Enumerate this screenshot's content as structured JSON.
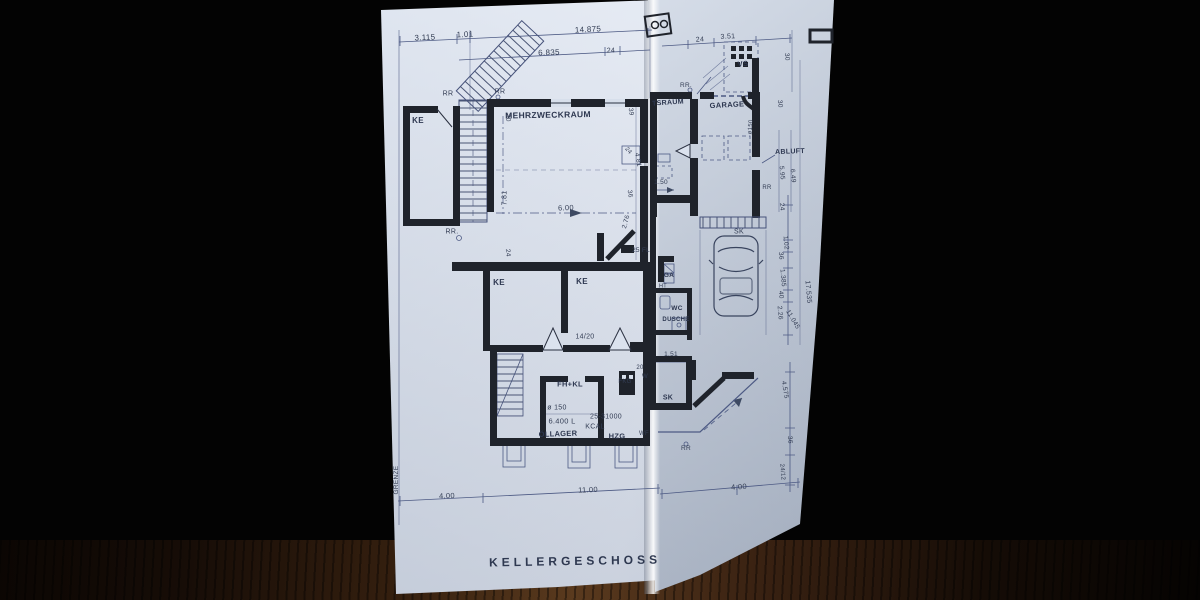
{
  "title": {
    "text": "KELLERGESCHOSS"
  },
  "colors": {
    "paper": "#d3dbe8",
    "ink": "#3e4a63",
    "wall": "#1f232b",
    "wood": "#3a2315"
  },
  "annotations": [
    {
      "kind": "dim",
      "text": "3.115",
      "x": 425,
      "y": 38,
      "rot": -3,
      "fs": 8
    },
    {
      "kind": "dim",
      "text": "1.01",
      "x": 465,
      "y": 35,
      "rot": -3,
      "fs": 8
    },
    {
      "kind": "dim",
      "text": "14.875",
      "x": 588,
      "y": 30,
      "rot": -3,
      "fs": 8
    },
    {
      "kind": "dim",
      "text": "6.835",
      "x": 549,
      "y": 53,
      "rot": -2,
      "fs": 8
    },
    {
      "kind": "dim",
      "text": "24",
      "x": 611,
      "y": 51,
      "rot": -2,
      "fs": 7
    },
    {
      "kind": "marker",
      "text": "RR",
      "x": 448,
      "y": 94,
      "rot": 0,
      "fs": 7
    },
    {
      "kind": "marker",
      "text": "RR",
      "x": 500,
      "y": 92,
      "rot": 0,
      "fs": 7
    },
    {
      "kind": "room",
      "text": "KE",
      "x": 418,
      "y": 121,
      "rot": 0,
      "fs": 8
    },
    {
      "kind": "room",
      "text": "MEHRZWECKRAUM",
      "x": 548,
      "y": 115,
      "rot": -1,
      "fs": 8.5
    },
    {
      "kind": "dim",
      "text": "30",
      "x": 507,
      "y": 118,
      "rot": 85,
      "fs": 6.5
    },
    {
      "kind": "dim",
      "text": "7.81",
      "x": 505,
      "y": 198,
      "rot": -90,
      "fs": 7
    },
    {
      "kind": "dim",
      "text": "6.00",
      "x": 566,
      "y": 208,
      "rot": -2,
      "fs": 7.5
    },
    {
      "kind": "dim",
      "text": "2.76",
      "x": 627,
      "y": 222,
      "rot": -75,
      "fs": 6.5
    },
    {
      "kind": "dim",
      "text": "39",
      "x": 630,
      "y": 112,
      "rot": 80,
      "fs": 6.5
    },
    {
      "kind": "dim",
      "text": "24",
      "x": 628,
      "y": 151,
      "rot": 50,
      "fs": 6
    },
    {
      "kind": "dim",
      "text": "4.81",
      "x": 637,
      "y": 160,
      "rot": 80,
      "fs": 6.5
    },
    {
      "kind": "dim",
      "text": "36",
      "x": 629,
      "y": 194,
      "rot": 80,
      "fs": 6.5
    },
    {
      "kind": "marker",
      "text": "RR.",
      "x": 452,
      "y": 232,
      "rot": 0,
      "fs": 7
    },
    {
      "kind": "dim",
      "text": "24",
      "x": 507,
      "y": 253,
      "rot": 85,
      "fs": 6.5
    },
    {
      "kind": "marker",
      "text": "25 FL",
      "x": 641,
      "y": 251,
      "rot": 0,
      "fs": 6.5
    },
    {
      "kind": "room",
      "text": "KE",
      "x": 499,
      "y": 283,
      "rot": 0,
      "fs": 8
    },
    {
      "kind": "room",
      "text": "KE",
      "x": 582,
      "y": 282,
      "rot": 0,
      "fs": 8
    },
    {
      "kind": "dim",
      "text": "14/20",
      "x": 585,
      "y": 337,
      "rot": 0,
      "fs": 7
    },
    {
      "kind": "room",
      "text": "FH+KL",
      "x": 570,
      "y": 384,
      "rot": 0,
      "fs": 7.5
    },
    {
      "kind": "marker",
      "text": "FKG",
      "x": 625,
      "y": 382,
      "rot": 0,
      "fs": 6
    },
    {
      "kind": "dim",
      "text": "20",
      "x": 640,
      "y": 368,
      "rot": 0,
      "fs": 6
    },
    {
      "kind": "marker",
      "text": "W",
      "x": 645,
      "y": 377,
      "rot": 0,
      "fs": 6
    },
    {
      "kind": "dim",
      "text": "ø 150",
      "x": 557,
      "y": 408,
      "rot": 0,
      "fs": 7
    },
    {
      "kind": "dim",
      "text": "6.400 L",
      "x": 562,
      "y": 421,
      "rot": 0,
      "fs": 7.5
    },
    {
      "kind": "room",
      "text": "ÖLLAGER",
      "x": 558,
      "y": 434,
      "rot": -2,
      "fs": 7.5
    },
    {
      "kind": "dim",
      "text": "25-31000",
      "x": 606,
      "y": 417,
      "rot": 0,
      "fs": 7
    },
    {
      "kind": "dim",
      "text": "KCAL",
      "x": 595,
      "y": 427,
      "rot": 0,
      "fs": 7
    },
    {
      "kind": "room",
      "text": "HZG",
      "x": 617,
      "y": 436,
      "rot": 0,
      "fs": 7.5
    },
    {
      "kind": "marker",
      "text": "WF",
      "x": 644,
      "y": 434,
      "rot": 0,
      "fs": 6
    },
    {
      "kind": "marker",
      "text": "GRENZE",
      "x": 397,
      "y": 480,
      "rot": -90,
      "fs": 6.5
    },
    {
      "kind": "dim",
      "text": "4.00",
      "x": 447,
      "y": 496,
      "rot": -2,
      "fs": 7.5
    },
    {
      "kind": "dim",
      "text": "11.00",
      "x": 588,
      "y": 490,
      "rot": -2,
      "fs": 7.5
    },
    {
      "kind": "dim",
      "text": "24",
      "x": 700,
      "y": 40,
      "rot": -3,
      "fs": 7
    },
    {
      "kind": "dim",
      "text": "3.51",
      "x": 728,
      "y": 37,
      "rot": -3,
      "fs": 7
    },
    {
      "kind": "room",
      "text": "VS",
      "x": 743,
      "y": 64,
      "rot": -5,
      "fs": 7.5
    },
    {
      "kind": "marker",
      "text": "RR.",
      "x": 686,
      "y": 86,
      "rot": 0,
      "fs": 6.5
    },
    {
      "kind": "room",
      "text": "TSRAUM",
      "x": 668,
      "y": 103,
      "rot": -4,
      "fs": 7
    },
    {
      "kind": "room",
      "text": "GARAGE",
      "x": 727,
      "y": 105,
      "rot": -3,
      "fs": 7.5
    },
    {
      "kind": "dim",
      "text": "ø150",
      "x": 751,
      "y": 127,
      "rot": -85,
      "fs": 6
    },
    {
      "kind": "dim",
      "text": "1.50",
      "x": 661,
      "y": 183,
      "rot": 0,
      "fs": 6.5
    },
    {
      "kind": "room",
      "text": "ABLUFT",
      "x": 790,
      "y": 152,
      "rot": -2,
      "fs": 7
    },
    {
      "kind": "dim",
      "text": "5.95",
      "x": 781,
      "y": 173,
      "rot": 85,
      "fs": 6.5
    },
    {
      "kind": "dim",
      "text": "6.49",
      "x": 792,
      "y": 176,
      "rot": 85,
      "fs": 6.5
    },
    {
      "kind": "dim",
      "text": "30",
      "x": 786,
      "y": 57,
      "rot": 85,
      "fs": 6.5
    },
    {
      "kind": "dim",
      "text": "30",
      "x": 779,
      "y": 104,
      "rot": 85,
      "fs": 6.5
    },
    {
      "kind": "marker",
      "text": "SK",
      "x": 739,
      "y": 232,
      "rot": 0,
      "fs": 7
    },
    {
      "kind": "marker",
      "text": "RR",
      "x": 767,
      "y": 188,
      "rot": 0,
      "fs": 6
    },
    {
      "kind": "room",
      "text": "GA",
      "x": 669,
      "y": 276,
      "rot": 0,
      "fs": 6.5
    },
    {
      "kind": "marker",
      "text": "HT",
      "x": 663,
      "y": 287,
      "rot": 0,
      "fs": 5.5
    },
    {
      "kind": "room",
      "text": "WC",
      "x": 677,
      "y": 309,
      "rot": 0,
      "fs": 6.5
    },
    {
      "kind": "room",
      "text": "DUSCHE",
      "x": 676,
      "y": 320,
      "rot": 0,
      "fs": 6
    },
    {
      "kind": "dim",
      "text": "1.51",
      "x": 671,
      "y": 355,
      "rot": 0,
      "fs": 6.5
    },
    {
      "kind": "room",
      "text": "SK",
      "x": 668,
      "y": 398,
      "rot": 0,
      "fs": 7
    },
    {
      "kind": "dim",
      "text": "24",
      "x": 781,
      "y": 207,
      "rot": 85,
      "fs": 6.5
    },
    {
      "kind": "dim",
      "text": "1.02",
      "x": 785,
      "y": 243,
      "rot": 85,
      "fs": 6.5
    },
    {
      "kind": "dim",
      "text": "36",
      "x": 780,
      "y": 256,
      "rot": 85,
      "fs": 6.5
    },
    {
      "kind": "dim",
      "text": "1.385",
      "x": 782,
      "y": 278,
      "rot": 85,
      "fs": 6.5
    },
    {
      "kind": "dim",
      "text": "40",
      "x": 780,
      "y": 295,
      "rot": 85,
      "fs": 6.5
    },
    {
      "kind": "dim",
      "text": "2.26",
      "x": 779,
      "y": 313,
      "rot": 85,
      "fs": 6.5
    },
    {
      "kind": "dim",
      "text": "11.045",
      "x": 792,
      "y": 320,
      "rot": 60,
      "fs": 6.5
    },
    {
      "kind": "dim",
      "text": "17.535",
      "x": 808,
      "y": 292,
      "rot": 85,
      "fs": 7
    },
    {
      "kind": "dim",
      "text": "4.575",
      "x": 784,
      "y": 390,
      "rot": 80,
      "fs": 6.5
    },
    {
      "kind": "dim",
      "text": "36",
      "x": 789,
      "y": 440,
      "rot": 85,
      "fs": 6.5
    },
    {
      "kind": "dim",
      "text": "24/12",
      "x": 782,
      "y": 472,
      "rot": 85,
      "fs": 6
    },
    {
      "kind": "marker",
      "text": "RR",
      "x": 686,
      "y": 449,
      "rot": 0,
      "fs": 6.5
    },
    {
      "kind": "dim",
      "text": "4.00",
      "x": 739,
      "y": 487,
      "rot": -4,
      "fs": 7.5
    }
  ]
}
